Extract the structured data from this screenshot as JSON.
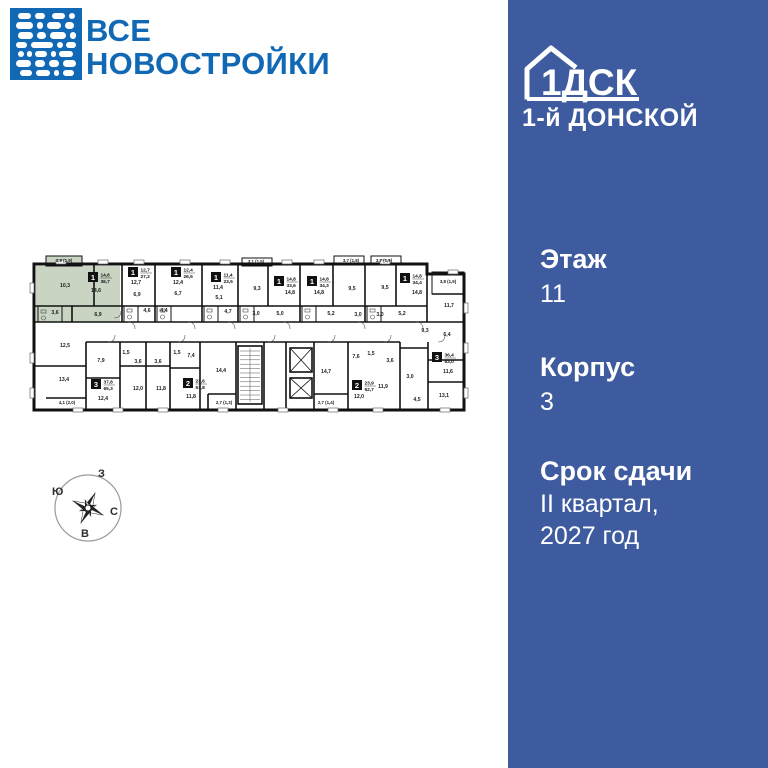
{
  "colors": {
    "brand_blue": "#1168b5",
    "sidebar_blue": "#3d5b9e",
    "highlight_green": "#c9d4c2",
    "wall_black": "#111111"
  },
  "brand": {
    "line1": "ВСЕ",
    "line2": "НОВОСТРОЙКИ"
  },
  "sidebar": {
    "developer": "1ДСК",
    "project": "1-й ДОНСКОЙ",
    "floor_label": "Этаж",
    "floor_value": "11",
    "building_label": "Корпус",
    "building_value": "3",
    "deadline_label": "Срок сдачи",
    "deadline_line1": "II квартал,",
    "deadline_line2": "2027 год"
  },
  "compass": {
    "top": "З",
    "left": "Ю",
    "right": "С",
    "bottom": "В"
  },
  "floorplan": {
    "units": [
      {
        "x": 60,
        "y": 24,
        "rooms": "1",
        "living": "14,6",
        "total": "36,7",
        "highlighted": true
      },
      {
        "x": 100,
        "y": 19,
        "rooms": "1",
        "living": "12,7",
        "total": "27,2"
      },
      {
        "x": 143,
        "y": 19,
        "rooms": "1",
        "living": "12,4",
        "total": "26,5"
      },
      {
        "x": 183,
        "y": 24,
        "rooms": "1",
        "living": "11,4",
        "total": "23,5"
      },
      {
        "x": 246,
        "y": 28,
        "rooms": "1",
        "living": "14,8",
        "total": "33,6"
      },
      {
        "x": 279,
        "y": 28,
        "rooms": "1",
        "living": "14,8",
        "total": "34,3"
      },
      {
        "x": 372,
        "y": 25,
        "rooms": "1",
        "living": "14,8",
        "total": "34,4"
      },
      {
        "x": 63,
        "y": 131,
        "rooms": "3",
        "living": "37,8",
        "total": "65,3"
      },
      {
        "x": 155,
        "y": 130,
        "rooms": "2",
        "living": "23,6",
        "total": "51,8"
      },
      {
        "x": 324,
        "y": 132,
        "rooms": "2",
        "living": "23,9",
        "total": "52,7"
      },
      {
        "x": 404,
        "y": 104,
        "rooms": "3",
        "living": "36,4",
        "total": "63,0"
      }
    ],
    "labels": [
      {
        "x": 36,
        "y": 14,
        "t": "3,9 (1,9)"
      },
      {
        "x": 37,
        "y": 39,
        "t": "10,3"
      },
      {
        "x": 68,
        "y": 44,
        "t": "14,6"
      },
      {
        "x": 27,
        "y": 66,
        "t": "3,6"
      },
      {
        "x": 70,
        "y": 68,
        "t": "6,9"
      },
      {
        "x": 108,
        "y": 36,
        "t": "12,7"
      },
      {
        "x": 109,
        "y": 48,
        "t": "6,9"
      },
      {
        "x": 119,
        "y": 64,
        "t": "4,6"
      },
      {
        "x": 150,
        "y": 36,
        "t": "12,4"
      },
      {
        "x": 150,
        "y": 47,
        "t": "6,7"
      },
      {
        "x": 136,
        "y": 64,
        "t": "4,4"
      },
      {
        "x": 190,
        "y": 41,
        "t": "11,4"
      },
      {
        "x": 191,
        "y": 51,
        "t": "5,1"
      },
      {
        "x": 200,
        "y": 65,
        "t": "4,7"
      },
      {
        "x": 228,
        "y": 15,
        "t": "3,1 (1,5)"
      },
      {
        "x": 229,
        "y": 42,
        "t": "9,3"
      },
      {
        "x": 228,
        "y": 67,
        "t": "3,0"
      },
      {
        "x": 252,
        "y": 67,
        "t": "5,0"
      },
      {
        "x": 262,
        "y": 46,
        "t": "14,8"
      },
      {
        "x": 291,
        "y": 46,
        "t": "14,8"
      },
      {
        "x": 303,
        "y": 67,
        "t": "5,2"
      },
      {
        "x": 323,
        "y": 14,
        "t": "3,7 (1,8)"
      },
      {
        "x": 324,
        "y": 42,
        "t": "9,5"
      },
      {
        "x": 330,
        "y": 68,
        "t": "3,0"
      },
      {
        "x": 356,
        "y": 14,
        "t": "3,7 (1,9)"
      },
      {
        "x": 357,
        "y": 41,
        "t": "9,5"
      },
      {
        "x": 374,
        "y": 67,
        "t": "5,2"
      },
      {
        "x": 352,
        "y": 68,
        "t": "3,0"
      },
      {
        "x": 389,
        "y": 46,
        "t": "14,8"
      },
      {
        "x": 420,
        "y": 35,
        "t": "3,8 (1,9)"
      },
      {
        "x": 421,
        "y": 59,
        "t": "11,7"
      },
      {
        "x": 397,
        "y": 84,
        "t": "9,3"
      },
      {
        "x": 419,
        "y": 88,
        "t": "6,4"
      },
      {
        "x": 37,
        "y": 99,
        "t": "12,5"
      },
      {
        "x": 73,
        "y": 114,
        "t": "7,9"
      },
      {
        "x": 36,
        "y": 133,
        "t": "13,4"
      },
      {
        "x": 39,
        "y": 156,
        "t": "4,1 (2,0)"
      },
      {
        "x": 75,
        "y": 152,
        "t": "12,4"
      },
      {
        "x": 110,
        "y": 142,
        "t": "12,0"
      },
      {
        "x": 133,
        "y": 142,
        "t": "11,8"
      },
      {
        "x": 98,
        "y": 106,
        "t": "1,5"
      },
      {
        "x": 110,
        "y": 115,
        "t": "3,6"
      },
      {
        "x": 130,
        "y": 115,
        "t": "3,6"
      },
      {
        "x": 149,
        "y": 106,
        "t": "1,5"
      },
      {
        "x": 163,
        "y": 109,
        "t": "7,4"
      },
      {
        "x": 163,
        "y": 150,
        "t": "11,8"
      },
      {
        "x": 193,
        "y": 124,
        "t": "14,4"
      },
      {
        "x": 196,
        "y": 156,
        "t": "2,7 (1,3)"
      },
      {
        "x": 298,
        "y": 125,
        "t": "14,7"
      },
      {
        "x": 298,
        "y": 156,
        "t": "2,7 (1,4)"
      },
      {
        "x": 328,
        "y": 110,
        "t": "7,6"
      },
      {
        "x": 343,
        "y": 107,
        "t": "1,5"
      },
      {
        "x": 362,
        "y": 114,
        "t": "3,6"
      },
      {
        "x": 331,
        "y": 150,
        "t": "12,0"
      },
      {
        "x": 355,
        "y": 140,
        "t": "11,9"
      },
      {
        "x": 382,
        "y": 130,
        "t": "3,0"
      },
      {
        "x": 389,
        "y": 153,
        "t": "4,5"
      },
      {
        "x": 420,
        "y": 125,
        "t": "11,6"
      },
      {
        "x": 416,
        "y": 149,
        "t": "13,1"
      }
    ]
  }
}
